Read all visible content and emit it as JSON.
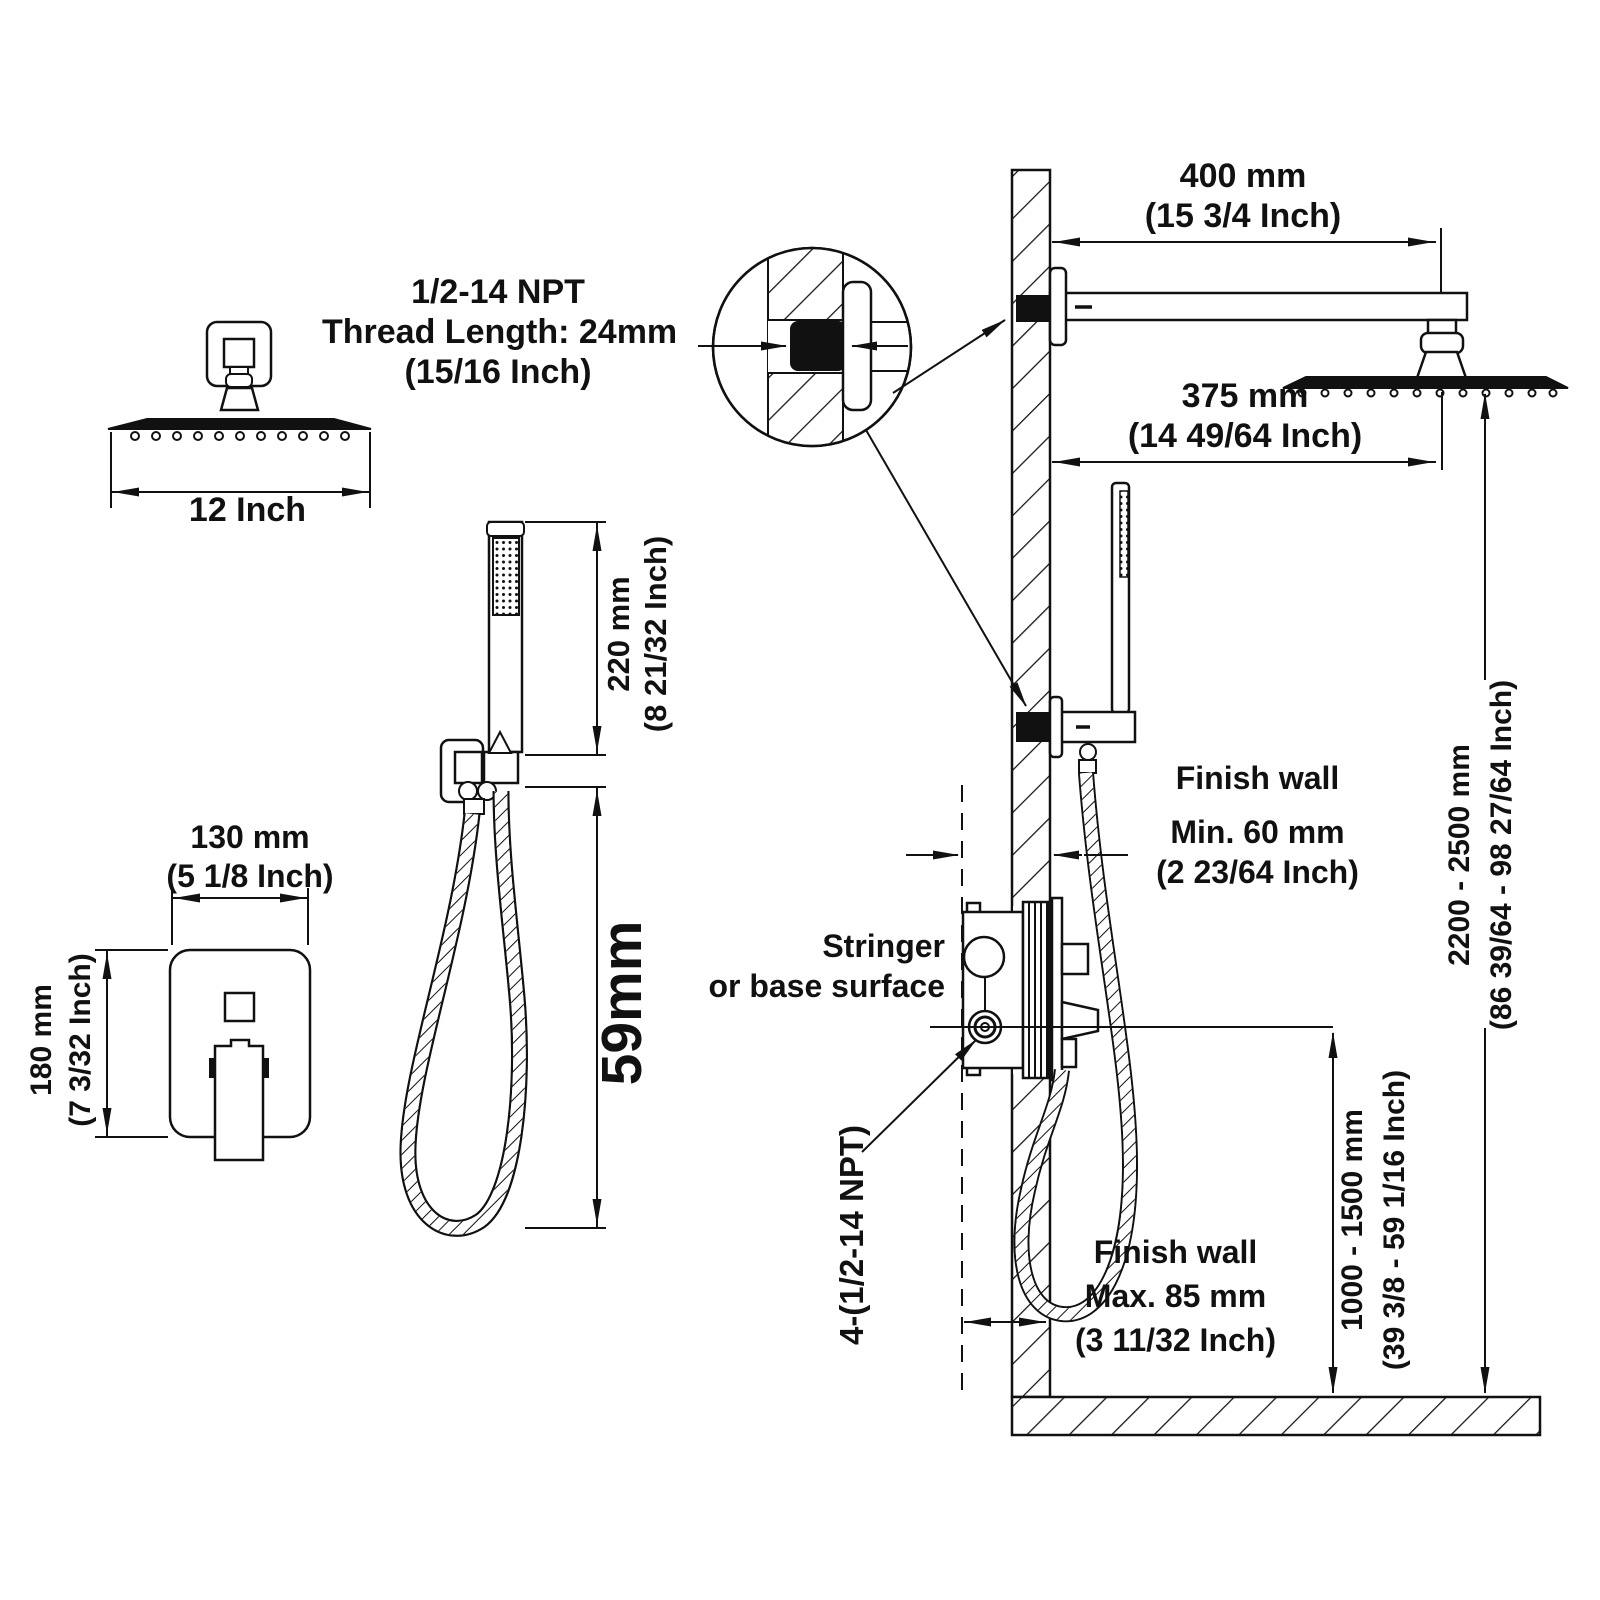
{
  "page": {
    "title": "Shower system installation dimension drawing"
  },
  "labels": {
    "arm_length": {
      "mm": "400 mm",
      "inch": "(15 3/4 Inch)"
    },
    "head_offset": {
      "mm": "375 mm",
      "inch": "(14 49/64 Inch)"
    },
    "thread_note": {
      "line1": "1/2-14 NPT",
      "line2": "Thread Length: 24mm",
      "line3": "(15/16 Inch)"
    },
    "head_width": {
      "inch": "12 Inch"
    },
    "wand_height": {
      "mm": "220 mm",
      "inch": "(8 21/32 Inch)"
    },
    "hose_dim": {
      "mm": "59mm"
    },
    "valve_width": {
      "mm": "130 mm",
      "inch": "(5 1/8 Inch)"
    },
    "valve_height": {
      "mm": "180 mm",
      "inch": "(7 3/32 Inch)"
    },
    "stringer_note": {
      "line1": "Stringer",
      "line2": "or base surface"
    },
    "finish_wall_min": {
      "title": "Finish wall",
      "mm": "Min. 60 mm",
      "inch": "(2 23/64 Inch)"
    },
    "finish_wall_max": {
      "title": "Finish wall",
      "mm": "Max. 85 mm",
      "inch": "(3 11/32 Inch)"
    },
    "npt_ports": {
      "text": "4-(1/2-14 NPT)"
    },
    "valve_height_range": {
      "mm": "1000 - 1500 mm",
      "inch": "(39 3/8 - 59 1/16 Inch)"
    },
    "head_height_range": {
      "mm": "2200 - 2500 mm",
      "inch": "(86 39/64 - 98 27/64 Inch)"
    }
  }
}
